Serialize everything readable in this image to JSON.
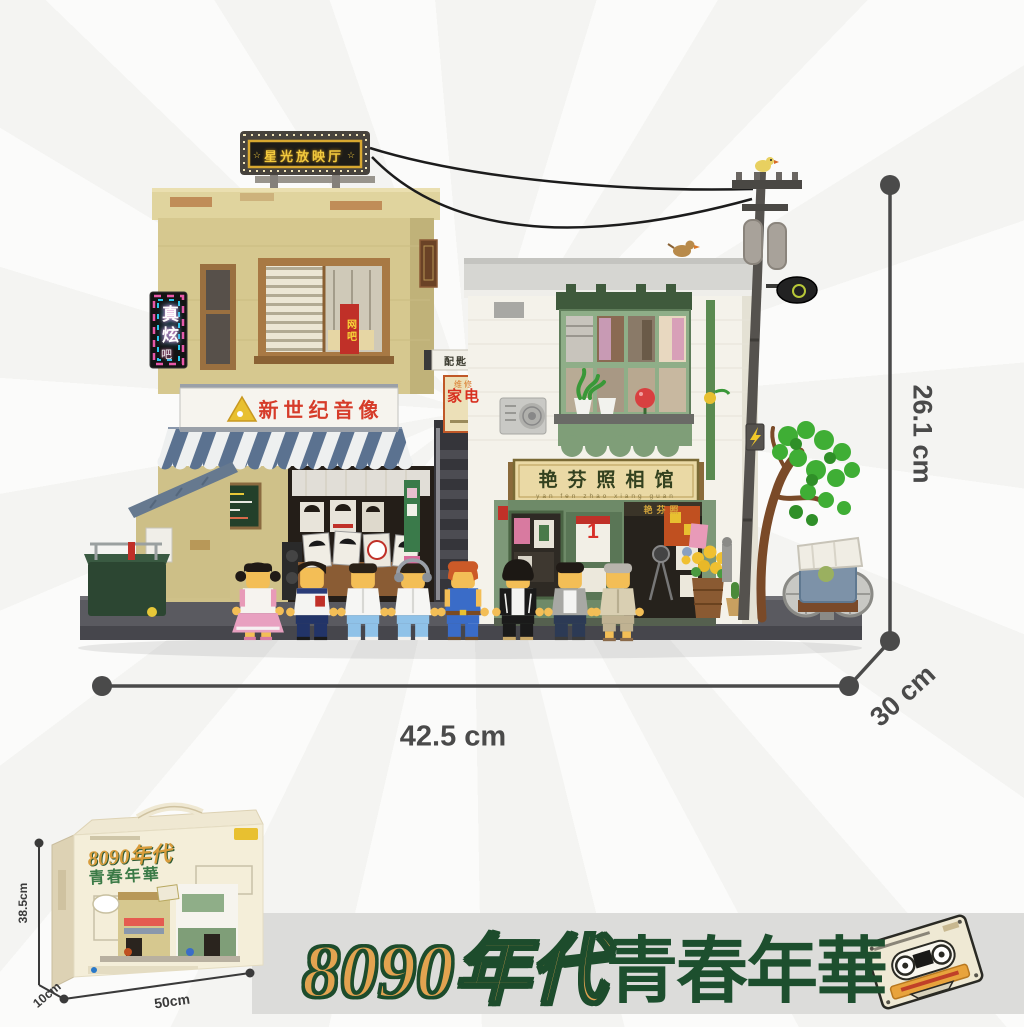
{
  "page": {
    "background": "#f5f5f4",
    "banner_background": "#dcdcda"
  },
  "model": {
    "signs": {
      "marquee_star": "☆",
      "marquee": "星光放映厅",
      "neon": "真炫",
      "neon_sub": "吧",
      "av_store": "新世纪音像",
      "key_service": "配匙",
      "appliance_small": "维修",
      "appliance_main": "家电",
      "internet_cafe": "网吧",
      "photo_studio": "艳芬照相馆",
      "photo_studio_pinyin": "yan fen zhao xiang guan",
      "photo_door_band": "艳芬照",
      "calendar_day": "1"
    }
  },
  "dimensions": {
    "width": "42.5 cm",
    "height": "26.1 cm",
    "depth": "30 cm",
    "line_color": "#4a4a4a"
  },
  "box": {
    "title_gold": "8090年代",
    "title_green": "青春年華",
    "height": "38.5cm",
    "depth": "10cm",
    "width": "50cm"
  },
  "banner": {
    "title_gold": "8090年代",
    "title_green": "青春年華",
    "gold_color": "#e2a350",
    "green_color": "#1d4f2e"
  },
  "icons": {
    "cassette": "cassette-tape",
    "bird": "sparrow",
    "key": "key",
    "lightning": "lightning-bolt",
    "star": "star"
  }
}
